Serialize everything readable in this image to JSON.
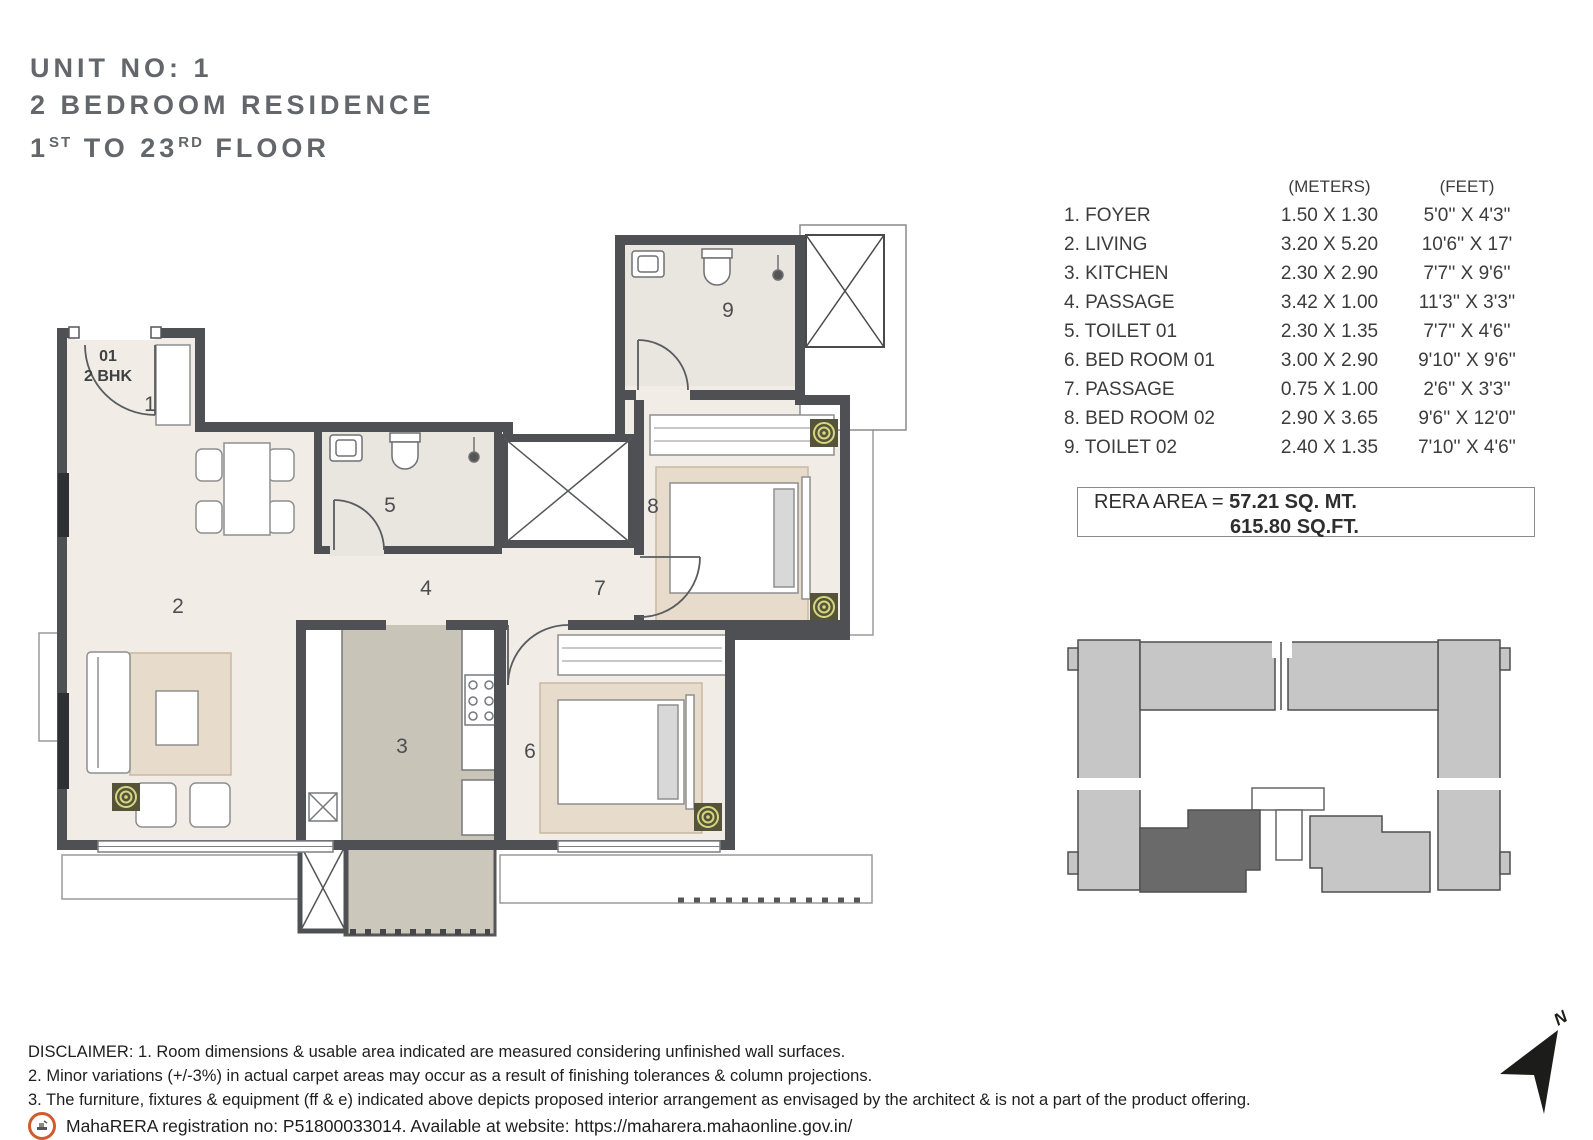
{
  "title": {
    "line1": "UNIT NO: 1",
    "line2": "2 BEDROOM RESIDENCE",
    "line3_num1": "1",
    "line3_sup1": "ST",
    "line3_mid": " TO 23",
    "line3_sup2": "RD",
    "line3_end": " FLOOR"
  },
  "dimensions_table": {
    "headers": {
      "meters": "(METERS)",
      "feet": "(FEET)"
    },
    "rows": [
      {
        "name": "1. FOYER",
        "meters": "1.50 X 1.30",
        "feet": "5'0'' X 4'3\""
      },
      {
        "name": "2. LIVING",
        "meters": "3.20 X 5.20",
        "feet": "10'6'' X 17'"
      },
      {
        "name": "3. KITCHEN",
        "meters": "2.30 X 2.90",
        "feet": "7'7'' X 9'6''"
      },
      {
        "name": "4. PASSAGE",
        "meters": "3.42 X 1.00",
        "feet": "11'3'' X 3'3''"
      },
      {
        "name": "5. TOILET 01",
        "meters": "2.30 X 1.35",
        "feet": "7'7'' X 4'6''"
      },
      {
        "name": "6. BED ROOM 01",
        "meters": "3.00 X 2.90",
        "feet": "9'10'' X 9'6''"
      },
      {
        "name": "7. PASSAGE",
        "meters": "0.75 X 1.00",
        "feet": "2'6'' X 3'3''"
      },
      {
        "name": "8. BED ROOM 02",
        "meters": "2.90 X 3.65",
        "feet": "9'6'' X 12'0\""
      },
      {
        "name": "9. TOILET 02",
        "meters": "2.40 X 1.35",
        "feet": "7'10'' X 4'6''"
      }
    ]
  },
  "rera": {
    "label": "RERA AREA = ",
    "sq_mt": "57.21 SQ. MT.",
    "sq_ft": "615.80 SQ.FT."
  },
  "plan": {
    "unit_tag_line1": "01",
    "unit_tag_line2": "2 BHK",
    "room_labels": {
      "foyer": "1",
      "living": "2",
      "kitchen": "3",
      "passage": "4",
      "toilet01": "5",
      "bedroom01": "6",
      "passage2": "7",
      "bedroom02": "8",
      "toilet02": "9"
    }
  },
  "north_label": "N",
  "disclaimer": {
    "line1": "DISCLAIMER: 1. Room dimensions & usable area indicated are measured considering unfinished wall surfaces.",
    "line2": "2. Minor variations (+/-3%) in actual carpet areas may occur as a result of finishing tolerances & column projections.",
    "line3": "3. The furniture, fixtures & equipment (ff & e) indicated above depicts proposed interior arrangement as envisaged by the architect & is not a part of the product offering."
  },
  "rera_registration": "MahaRERA registration no: P51800033014. Available at website: https://maharera.mahaonline.gov.in/",
  "colors": {
    "title_gray": "#63666a",
    "wall": "#4f5054",
    "floor": "#f1ede6",
    "toilet_floor": "#e9e5df",
    "kitchen_floor": "#c9c4b8",
    "rug": "#e7dccb",
    "gold_motif": "#d6d67e",
    "keyplan_light": "#c6c6c6",
    "keyplan_highlight": "#6a6a6a",
    "badge_orange": "#cf5b2e"
  }
}
